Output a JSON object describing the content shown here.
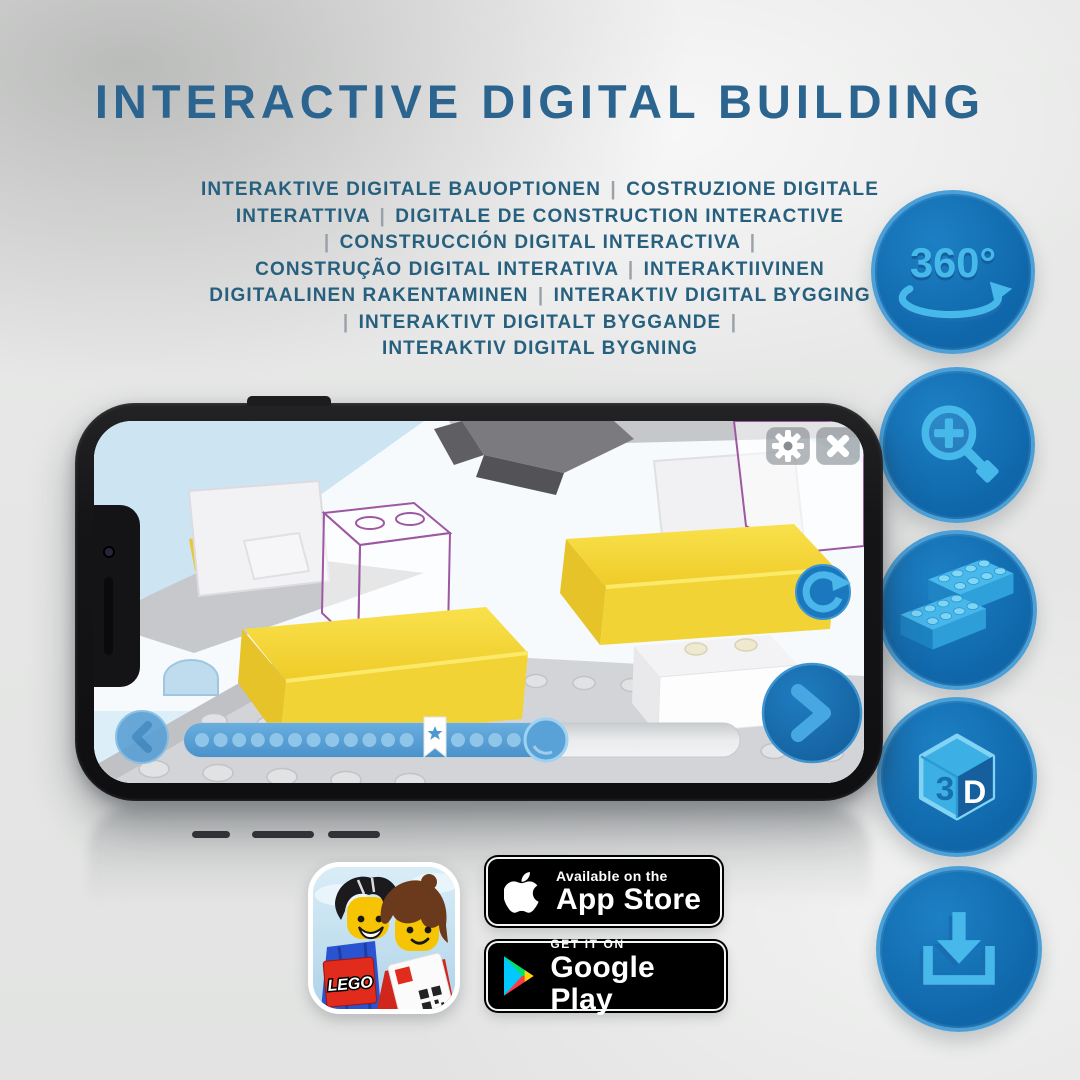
{
  "header": {
    "title": "INTERACTIVE DIGITAL BUILDING"
  },
  "subtitle": {
    "lines": [
      "INTERAKTIVE DIGITALE BAUOPTIONEN | COSTRUZIONE DIGITALE",
      "INTERATTIVA | DIGITALE DE CONSTRUCTION INTERACTIVE",
      "| CONSTRUCCIÓN DIGITAL INTERACTIVA |",
      "CONSTRUÇÃO DIGITAL INTERATIVA | INTERAKTIIVINEN",
      "DIGITAALINEN RAKENTAMINEN | INTERAKTIV DIGITAL BYGGING",
      "| INTERAKTIVT DIGITALT BYGGANDE |",
      "INTERAKTIV DIGITAL BYGNING"
    ]
  },
  "features": [
    {
      "id": "rotation-360",
      "label": "360°"
    },
    {
      "id": "zoom-in",
      "label": ""
    },
    {
      "id": "brick-building",
      "label": ""
    },
    {
      "id": "view-3d",
      "left": "3",
      "right": "D"
    },
    {
      "id": "download",
      "label": ""
    }
  ],
  "phone": {
    "progress": {
      "dots_before": 12,
      "dots_after": 4
    }
  },
  "badges": {
    "lego_app": {
      "logo_text": "LEGO"
    },
    "app_store": {
      "line1": "Available on the",
      "line2": "App Store"
    },
    "google_play": {
      "line1": "GET IT ON",
      "line2": "Google Play"
    }
  },
  "colors": {
    "title": "#2c6490",
    "subtitle": "#27607f",
    "circle_fill": "#1270b5",
    "circle_rim": "#4ba0d8",
    "glyph_light": "#47b8ea",
    "glyph_dark": "#1a6db0",
    "brick_yellow": "#f2d335",
    "ghost_outline": "#9e58a2"
  }
}
